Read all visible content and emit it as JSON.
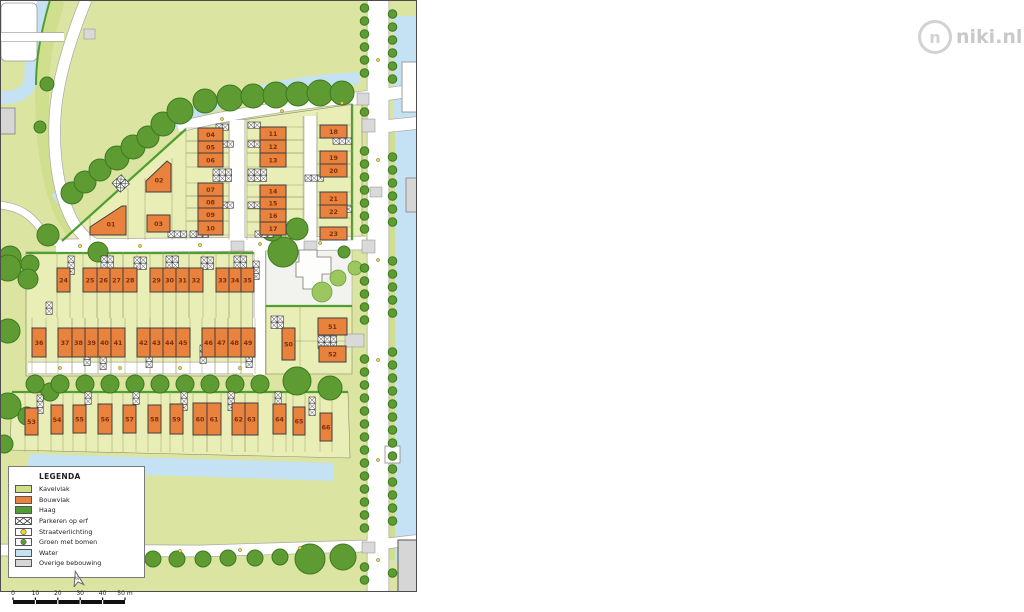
{
  "logo": {
    "text": "niki.nl",
    "monogram": "n"
  },
  "compass": {
    "label": "N"
  },
  "legend": {
    "title": "LEGENDA",
    "items": [
      {
        "label": "Kavelvlak",
        "swatch": "fill",
        "color": "#cfdd85"
      },
      {
        "label": "Bouwvlak",
        "swatch": "fill",
        "color": "#e8823c"
      },
      {
        "label": "Haag",
        "swatch": "fill",
        "color": "#4f9e33"
      },
      {
        "label": "Parkeren op erf",
        "swatch": "parking"
      },
      {
        "label": "Straatverlichting",
        "swatch": "light",
        "color": "#f2d41c"
      },
      {
        "label": "Groen met bomen",
        "swatch": "tree",
        "color": "#5f9b33"
      },
      {
        "label": "Water",
        "swatch": "fill",
        "color": "#c4e2f4"
      },
      {
        "label": "Overige bebouwing",
        "swatch": "fill",
        "color": "#d6d6d6"
      }
    ]
  },
  "scalebar": {
    "labels": [
      "0",
      "10",
      "20",
      "30",
      "40",
      "50 m"
    ]
  },
  "plan": {
    "colors": {
      "kavel_base": "#dbe4a0",
      "kavel_block": "#e9edb6",
      "verge": "#cfdf8e",
      "bouwvlak": "#e8823c",
      "plot_number": "#7a2f0b",
      "haag": "#4f9e33",
      "tree": "#5f9b33",
      "tree_dark_stroke": "#3d7a1e",
      "tree_light": "#9cc65e",
      "tree_light_stroke": "#6da33c",
      "water": "#c4e2f4",
      "road": "#ffffff",
      "road_casing": "#a9a9a9",
      "overig": "#d6d6d6",
      "lotline": "#9aa06c"
    },
    "plots": [
      {
        "nr": "01",
        "pts": [
          [
            90,
            235
          ],
          [
            90,
            227
          ],
          [
            122,
            206
          ],
          [
            126,
            206
          ],
          [
            126,
            235
          ]
        ],
        "cx": 111,
        "cy": 224
      },
      {
        "nr": "02",
        "pts": [
          [
            146,
            181
          ],
          [
            167,
            161
          ],
          [
            171,
            164
          ],
          [
            171,
            192
          ],
          [
            146,
            192
          ]
        ],
        "cx": 159,
        "cy": 180
      },
      {
        "nr": "03",
        "x": 147,
        "y": 215,
        "w": 23,
        "h": 17
      },
      {
        "nr": "04",
        "x": 198,
        "y": 128,
        "w": 25,
        "h": 13
      },
      {
        "nr": "05",
        "x": 198,
        "y": 141,
        "w": 25,
        "h": 12
      },
      {
        "nr": "06",
        "x": 198,
        "y": 153,
        "w": 25,
        "h": 14
      },
      {
        "nr": "07",
        "x": 198,
        "y": 183,
        "w": 25,
        "h": 13
      },
      {
        "nr": "08",
        "x": 198,
        "y": 196,
        "w": 25,
        "h": 12
      },
      {
        "nr": "09",
        "x": 198,
        "y": 208,
        "w": 25,
        "h": 13
      },
      {
        "nr": "10",
        "x": 198,
        "y": 221,
        "w": 25,
        "h": 14
      },
      {
        "nr": "11",
        "x": 260,
        "y": 127,
        "w": 26,
        "h": 13
      },
      {
        "nr": "12",
        "x": 260,
        "y": 140,
        "w": 26,
        "h": 13
      },
      {
        "nr": "13",
        "x": 260,
        "y": 153,
        "w": 26,
        "h": 14
      },
      {
        "nr": "14",
        "x": 260,
        "y": 185,
        "w": 26,
        "h": 12
      },
      {
        "nr": "15",
        "x": 260,
        "y": 197,
        "w": 26,
        "h": 12
      },
      {
        "nr": "16",
        "x": 260,
        "y": 209,
        "w": 26,
        "h": 13
      },
      {
        "nr": "17",
        "x": 260,
        "y": 222,
        "w": 26,
        "h": 13
      },
      {
        "nr": "18",
        "x": 320,
        "y": 125,
        "w": 27,
        "h": 13
      },
      {
        "nr": "19",
        "x": 320,
        "y": 151,
        "w": 27,
        "h": 13
      },
      {
        "nr": "20",
        "x": 320,
        "y": 164,
        "w": 27,
        "h": 13
      },
      {
        "nr": "21",
        "x": 320,
        "y": 192,
        "w": 27,
        "h": 13
      },
      {
        "nr": "22",
        "x": 320,
        "y": 205,
        "w": 27,
        "h": 13
      },
      {
        "nr": "23",
        "x": 320,
        "y": 227,
        "w": 27,
        "h": 13
      },
      {
        "nr": "24",
        "x": 57,
        "y": 268,
        "w": 13,
        "h": 24
      },
      {
        "nr": "25",
        "x": 83,
        "y": 268,
        "w": 14,
        "h": 24
      },
      {
        "nr": "26",
        "x": 97,
        "y": 268,
        "w": 13,
        "h": 24
      },
      {
        "nr": "27",
        "x": 110,
        "y": 268,
        "w": 13,
        "h": 24
      },
      {
        "nr": "28",
        "x": 123,
        "y": 268,
        "w": 14,
        "h": 24
      },
      {
        "nr": "29",
        "x": 150,
        "y": 268,
        "w": 13,
        "h": 24
      },
      {
        "nr": "30",
        "x": 163,
        "y": 268,
        "w": 13,
        "h": 24
      },
      {
        "nr": "31",
        "x": 176,
        "y": 268,
        "w": 13,
        "h": 24
      },
      {
        "nr": "32",
        "x": 189,
        "y": 268,
        "w": 14,
        "h": 24
      },
      {
        "nr": "33",
        "x": 216,
        "y": 268,
        "w": 13,
        "h": 24
      },
      {
        "nr": "34",
        "x": 229,
        "y": 268,
        "w": 12,
        "h": 24
      },
      {
        "nr": "35",
        "x": 241,
        "y": 268,
        "w": 13,
        "h": 24
      },
      {
        "nr": "36",
        "x": 32,
        "y": 328,
        "w": 14,
        "h": 29
      },
      {
        "nr": "37",
        "x": 58,
        "y": 328,
        "w": 14,
        "h": 29
      },
      {
        "nr": "38",
        "x": 72,
        "y": 328,
        "w": 13,
        "h": 29
      },
      {
        "nr": "39",
        "x": 85,
        "y": 328,
        "w": 13,
        "h": 29
      },
      {
        "nr": "40",
        "x": 98,
        "y": 328,
        "w": 13,
        "h": 29
      },
      {
        "nr": "41",
        "x": 111,
        "y": 328,
        "w": 14,
        "h": 29
      },
      {
        "nr": "42",
        "x": 137,
        "y": 328,
        "w": 13,
        "h": 29
      },
      {
        "nr": "43",
        "x": 150,
        "y": 328,
        "w": 13,
        "h": 29
      },
      {
        "nr": "44",
        "x": 163,
        "y": 328,
        "w": 13,
        "h": 29
      },
      {
        "nr": "45",
        "x": 176,
        "y": 328,
        "w": 14,
        "h": 29
      },
      {
        "nr": "46",
        "x": 202,
        "y": 328,
        "w": 13,
        "h": 29
      },
      {
        "nr": "47",
        "x": 215,
        "y": 328,
        "w": 13,
        "h": 29
      },
      {
        "nr": "48",
        "x": 228,
        "y": 328,
        "w": 13,
        "h": 29
      },
      {
        "nr": "49",
        "x": 241,
        "y": 328,
        "w": 14,
        "h": 29
      },
      {
        "nr": "50",
        "x": 282,
        "y": 328,
        "w": 13,
        "h": 32
      },
      {
        "nr": "51",
        "x": 318,
        "y": 318,
        "w": 29,
        "h": 17
      },
      {
        "nr": "52",
        "x": 319,
        "y": 346,
        "w": 27,
        "h": 16
      },
      {
        "nr": "53",
        "x": 25,
        "y": 408,
        "w": 13,
        "h": 27
      },
      {
        "nr": "54",
        "x": 51,
        "y": 405,
        "w": 12,
        "h": 29
      },
      {
        "nr": "55",
        "x": 73,
        "y": 405,
        "w": 13,
        "h": 28
      },
      {
        "nr": "56",
        "x": 98,
        "y": 404,
        "w": 14,
        "h": 30
      },
      {
        "nr": "57",
        "x": 123,
        "y": 405,
        "w": 13,
        "h": 28
      },
      {
        "nr": "58",
        "x": 148,
        "y": 405,
        "w": 13,
        "h": 28
      },
      {
        "nr": "59",
        "x": 170,
        "y": 404,
        "w": 13,
        "h": 30
      },
      {
        "nr": "60",
        "x": 193,
        "y": 403,
        "w": 14,
        "h": 32
      },
      {
        "nr": "61",
        "x": 207,
        "y": 403,
        "w": 14,
        "h": 32
      },
      {
        "nr": "62",
        "x": 232,
        "y": 403,
        "w": 13,
        "h": 32
      },
      {
        "nr": "63",
        "x": 245,
        "y": 403,
        "w": 13,
        "h": 32
      },
      {
        "nr": "64",
        "x": 273,
        "y": 404,
        "w": 13,
        "h": 30
      },
      {
        "nr": "65",
        "x": 293,
        "y": 407,
        "w": 12,
        "h": 28
      },
      {
        "nr": "66",
        "x": 320,
        "y": 413,
        "w": 12,
        "h": 28
      }
    ]
  }
}
